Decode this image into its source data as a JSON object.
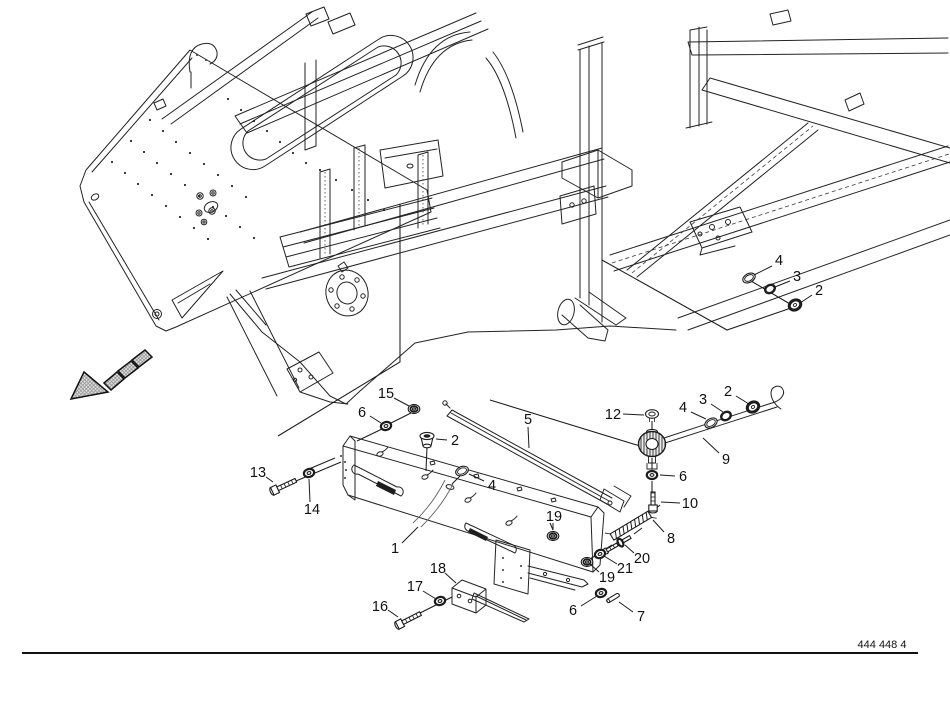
{
  "document": {
    "drawing_number": "444 448 4",
    "background_color": "#ffffff",
    "line_color": "#1c1c1c",
    "arrow_fill": "#dcdcdc"
  },
  "part_labels": [
    {
      "text": "4",
      "x": 779,
      "y": 260,
      "leader": [
        772,
        266,
        754,
        275
      ]
    },
    {
      "text": "3",
      "x": 797,
      "y": 276,
      "leader": [
        790,
        281,
        775,
        287
      ]
    },
    {
      "text": "2",
      "x": 819,
      "y": 290,
      "leader": [
        812,
        295,
        800,
        303
      ]
    },
    {
      "text": "2",
      "x": 728,
      "y": 391,
      "leader": [
        736,
        396,
        749,
        404
      ]
    },
    {
      "text": "3",
      "x": 703,
      "y": 399,
      "leader": [
        711,
        404,
        723,
        412
      ]
    },
    {
      "text": "4",
      "x": 683,
      "y": 407,
      "leader": [
        691,
        412,
        706,
        419
      ]
    },
    {
      "text": "12",
      "x": 613,
      "y": 414,
      "leader": [
        623,
        414,
        644,
        415
      ]
    },
    {
      "text": "9",
      "x": 726,
      "y": 459,
      "leader": [
        719,
        453,
        703,
        438
      ]
    },
    {
      "text": "6",
      "x": 683,
      "y": 476,
      "leader": [
        675,
        476,
        660,
        475
      ]
    },
    {
      "text": "10",
      "x": 690,
      "y": 503,
      "leader": [
        680,
        503,
        661,
        502
      ]
    },
    {
      "text": "5",
      "x": 528,
      "y": 419,
      "leader": [
        528,
        427,
        529,
        448
      ]
    },
    {
      "text": "15",
      "x": 386,
      "y": 393,
      "leader": [
        394,
        398,
        409,
        406
      ]
    },
    {
      "text": "6",
      "x": 362,
      "y": 412,
      "leader": [
        370,
        416,
        381,
        423
      ]
    },
    {
      "text": "2",
      "x": 455,
      "y": 440,
      "leader": [
        447,
        440,
        436,
        439
      ]
    },
    {
      "text": "4",
      "x": 492,
      "y": 485,
      "leader": [
        484,
        481,
        469,
        474
      ]
    },
    {
      "text": "13",
      "x": 258,
      "y": 472,
      "leader": [
        266,
        477,
        273,
        482
      ]
    },
    {
      "text": "14",
      "x": 312,
      "y": 509,
      "leader": [
        310,
        502,
        309,
        479
      ]
    },
    {
      "text": "1",
      "x": 395,
      "y": 548,
      "leader": [
        402,
        543,
        418,
        527
      ]
    },
    {
      "text": "19",
      "x": 554,
      "y": 516,
      "leader": [
        553,
        523,
        553,
        530
      ]
    },
    {
      "text": "8",
      "x": 671,
      "y": 538,
      "leader": [
        664,
        532,
        653,
        520
      ]
    },
    {
      "text": "20",
      "x": 642,
      "y": 558,
      "leader": [
        634,
        553,
        625,
        545
      ]
    },
    {
      "text": "21",
      "x": 625,
      "y": 568,
      "leader": [
        617,
        564,
        604,
        556
      ]
    },
    {
      "text": "19",
      "x": 607,
      "y": 577,
      "leader": [
        599,
        572,
        590,
        564
      ]
    },
    {
      "text": "6",
      "x": 573,
      "y": 610,
      "leader": [
        581,
        606,
        597,
        596
      ]
    },
    {
      "text": "7",
      "x": 641,
      "y": 616,
      "leader": [
        633,
        612,
        619,
        602
      ]
    },
    {
      "text": "18",
      "x": 438,
      "y": 568,
      "leader": [
        445,
        573,
        456,
        583
      ]
    },
    {
      "text": "17",
      "x": 415,
      "y": 586,
      "leader": [
        423,
        591,
        436,
        599
      ]
    },
    {
      "text": "16",
      "x": 380,
      "y": 606,
      "leader": [
        388,
        610,
        398,
        617
      ]
    }
  ],
  "part_symbols": [
    {
      "part": "4",
      "type": "ring_flat",
      "x": 749,
      "y": 278,
      "angle": -28
    },
    {
      "part": "3",
      "type": "ring_dark",
      "x": 770,
      "y": 289,
      "angle": -28
    },
    {
      "part": "2",
      "type": "ring_dark_big",
      "x": 795,
      "y": 305,
      "angle": -28
    },
    {
      "part": "4",
      "type": "ring_flat",
      "x": 711,
      "y": 423,
      "angle": -30
    },
    {
      "part": "3",
      "type": "ring_dark",
      "x": 726,
      "y": 416,
      "angle": -30
    },
    {
      "part": "2",
      "type": "ring_dark_big",
      "x": 753,
      "y": 407,
      "angle": -30
    },
    {
      "part": "12",
      "type": "screw_top",
      "x": 652,
      "y": 414,
      "angle": 0
    },
    {
      "part": "9",
      "type": "knob",
      "x": 652,
      "y": 444,
      "angle": 0
    },
    {
      "part": "6",
      "type": "washer",
      "x": 652,
      "y": 475,
      "angle": 0
    },
    {
      "part": "10",
      "type": "bolt",
      "x": 653,
      "y": 508,
      "angle": -90,
      "len": 17
    },
    {
      "part": "8",
      "type": "spring",
      "x": 612,
      "y": 537,
      "angle": -31,
      "len": 44
    },
    {
      "part": "20",
      "type": "rod",
      "x": 606,
      "y": 551,
      "angle": -30,
      "len": 27
    },
    {
      "part": "21",
      "type": "washer",
      "x": 600,
      "y": 554,
      "angle": -22
    },
    {
      "part": "19",
      "type": "nut",
      "x": 587,
      "y": 562,
      "angle": 0
    },
    {
      "part": "19",
      "type": "nut",
      "x": 553,
      "y": 536,
      "angle": 0
    },
    {
      "part": "6",
      "type": "washer",
      "x": 601,
      "y": 593,
      "angle": -15
    },
    {
      "part": "7",
      "type": "pin",
      "x": 613,
      "y": 598,
      "angle": -31
    },
    {
      "part": "13",
      "type": "bolt",
      "x": 275,
      "y": 490,
      "angle": -25,
      "len": 24
    },
    {
      "part": "14",
      "type": "washer",
      "x": 309,
      "y": 473,
      "angle": -15
    },
    {
      "part": "15",
      "type": "nut",
      "x": 414,
      "y": 409,
      "angle": 0
    },
    {
      "part": "6",
      "type": "washer",
      "x": 386,
      "y": 426,
      "angle": -15
    },
    {
      "part": "2",
      "type": "plug",
      "x": 427,
      "y": 439,
      "angle": 0
    },
    {
      "part": "4",
      "type": "ring_flat",
      "x": 462,
      "y": 471,
      "angle": -22
    },
    {
      "part": "16",
      "type": "bolt",
      "x": 400,
      "y": 624,
      "angle": -27,
      "len": 24
    },
    {
      "part": "17",
      "type": "washer",
      "x": 440,
      "y": 601,
      "angle": -15
    }
  ]
}
